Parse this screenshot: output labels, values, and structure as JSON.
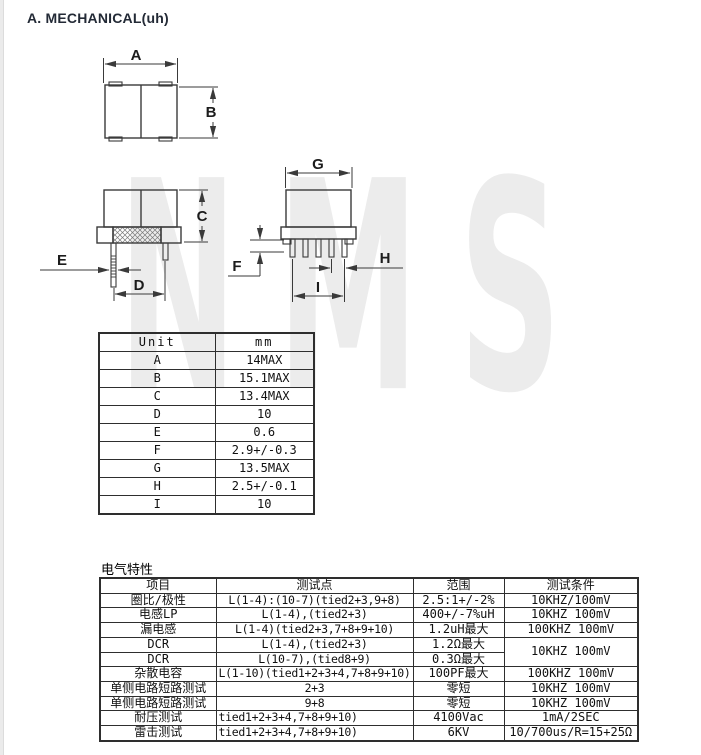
{
  "window": {
    "title": "A. MECHANICAL(uh)"
  },
  "watermark": {
    "text": "NMS"
  },
  "mechanical": {
    "dim_labels": {
      "A": "A",
      "B": "B",
      "C": "C",
      "D": "D",
      "E": "E",
      "F": "F",
      "G": "G",
      "H": "H",
      "I": "I"
    }
  },
  "dim_table": {
    "headers": [
      "Unit",
      "mm"
    ],
    "rows": [
      [
        "A",
        "14MAX"
      ],
      [
        "B",
        "15.1MAX"
      ],
      [
        "C",
        "13.4MAX"
      ],
      [
        "D",
        "10"
      ],
      [
        "E",
        "0.6"
      ],
      [
        "F",
        "2.9+/-0.3"
      ],
      [
        "G",
        "13.5MAX"
      ],
      [
        "H",
        "2.5+/-0.1"
      ],
      [
        "I",
        "10"
      ]
    ]
  },
  "electrical": {
    "section_title": "电气特性",
    "headers": [
      "项目",
      "测试点",
      "范围",
      "测试条件"
    ],
    "rows": [
      {
        "item": "圈比/极性",
        "point": "L(1-4):(10-7)(tied2+3,9+8)",
        "range": "2.5:1+/-2%",
        "cond": "10KHZ/100mV"
      },
      {
        "item": "电感LP",
        "point": "L(1-4),(tied2+3)",
        "range": "400+/-7%uH",
        "cond": "10KHZ 100mV"
      },
      {
        "item": "漏电感",
        "point": "L(1-4)(tied2+3,7+8+9+10)",
        "range": "1.2uH最大",
        "cond": "100KHZ 100mV"
      },
      {
        "item": "DCR",
        "point": "L(1-4),(tied2+3)",
        "range": "1.2Ω最大",
        "cond": "10KHZ 100mV",
        "cond_rowspan": 2
      },
      {
        "item": "DCR",
        "point": "L(10-7),(tied8+9)",
        "range": "0.3Ω最大",
        "cond": null
      },
      {
        "item": "杂散电容",
        "point": "L(1-10)(tied1+2+3+4,7+8+9+10)",
        "range": "100PF最大",
        "cond": "100KHZ 100mV"
      },
      {
        "item": "单侧电路短路测试",
        "point": "2+3",
        "range": "零短",
        "cond": "10KHZ 100mV"
      },
      {
        "item": "单侧电路短路测试",
        "point": "9+8",
        "range": "零短",
        "cond": "10KHZ 100mV"
      },
      {
        "item": "耐压测试",
        "point": "tied1+2+3+4,7+8+9+10)",
        "range": "4100Vac",
        "cond": "1mA/2SEC",
        "point_align": "left"
      },
      {
        "item": "雷击测试",
        "point": "tied1+2+3+4,7+8+9+10)",
        "range": "6KV",
        "cond": "10/700us/R=15+25Ω",
        "point_align": "left"
      }
    ]
  }
}
